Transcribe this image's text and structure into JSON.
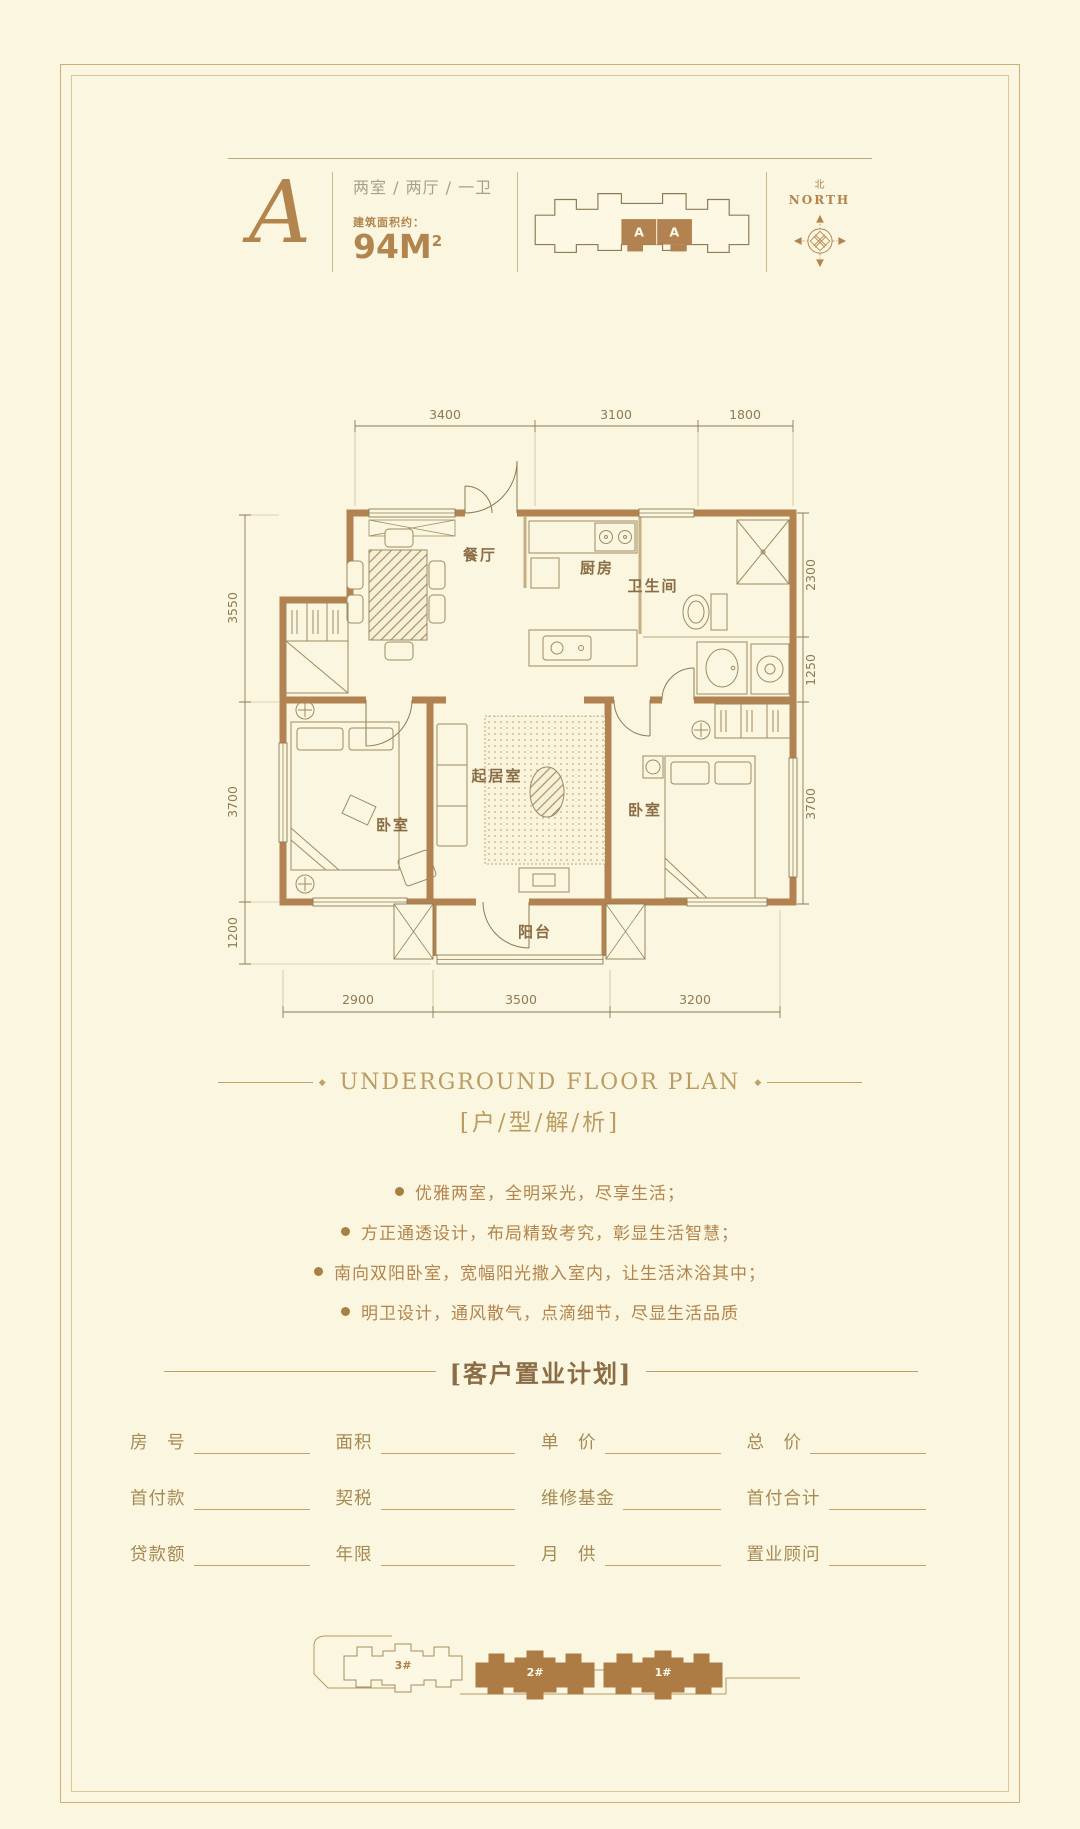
{
  "colors": {
    "background": "#fbf6df",
    "accent_gold": "#b2854e",
    "wall_brown": "#b28350",
    "frame_gold": "#cbb07c",
    "text_gray": "#a9a08c"
  },
  "header": {
    "unit_letter": "A",
    "unit_type": "两室 / 两厅 / 一卫",
    "area_label": "建筑面积约：",
    "area_value": "94M",
    "area_sup": "2",
    "keyplan": {
      "units": [
        "A",
        "A"
      ]
    },
    "compass": {
      "cn": "北",
      "en": "NORTH"
    }
  },
  "floorplan": {
    "dims_top": [
      "3400",
      "3100",
      "1800"
    ],
    "dims_left": [
      "3550",
      "3700",
      "1200"
    ],
    "dims_right": [
      "2300",
      "1250",
      "3700"
    ],
    "dims_bottom": [
      "2900",
      "3500",
      "3200"
    ],
    "rooms": {
      "dining": "餐厅",
      "kitchen": "厨房",
      "bath": "卫生间",
      "living": "起居室",
      "bedroom_left": "卧室",
      "bedroom_right": "卧室",
      "balcony": "阳台"
    }
  },
  "analysis": {
    "title_en": "UNDERGROUND FLOOR PLAN",
    "title_cn": "[户/型/解/析]",
    "bullets": [
      "优雅两室，全明采光，尽享生活；",
      "方正通透设计，布局精致考究，彰显生活智慧；",
      "南向双阳卧室，宽幅阳光撒入室内，让生活沐浴其中；",
      "明卫设计，通风散气，点滴细节，尽显生活品质"
    ]
  },
  "purchase_plan": {
    "title": "[客户置业计划]",
    "rows": [
      [
        "房　号",
        "面积",
        "单　价",
        "总　价"
      ],
      [
        "首付款",
        "契税",
        "维修基金",
        "首付合计"
      ],
      [
        "贷款额",
        "年限",
        "月　供",
        "置业顾问"
      ]
    ]
  },
  "siteplan": {
    "buildings": [
      "3#",
      "2#",
      "1#"
    ]
  }
}
